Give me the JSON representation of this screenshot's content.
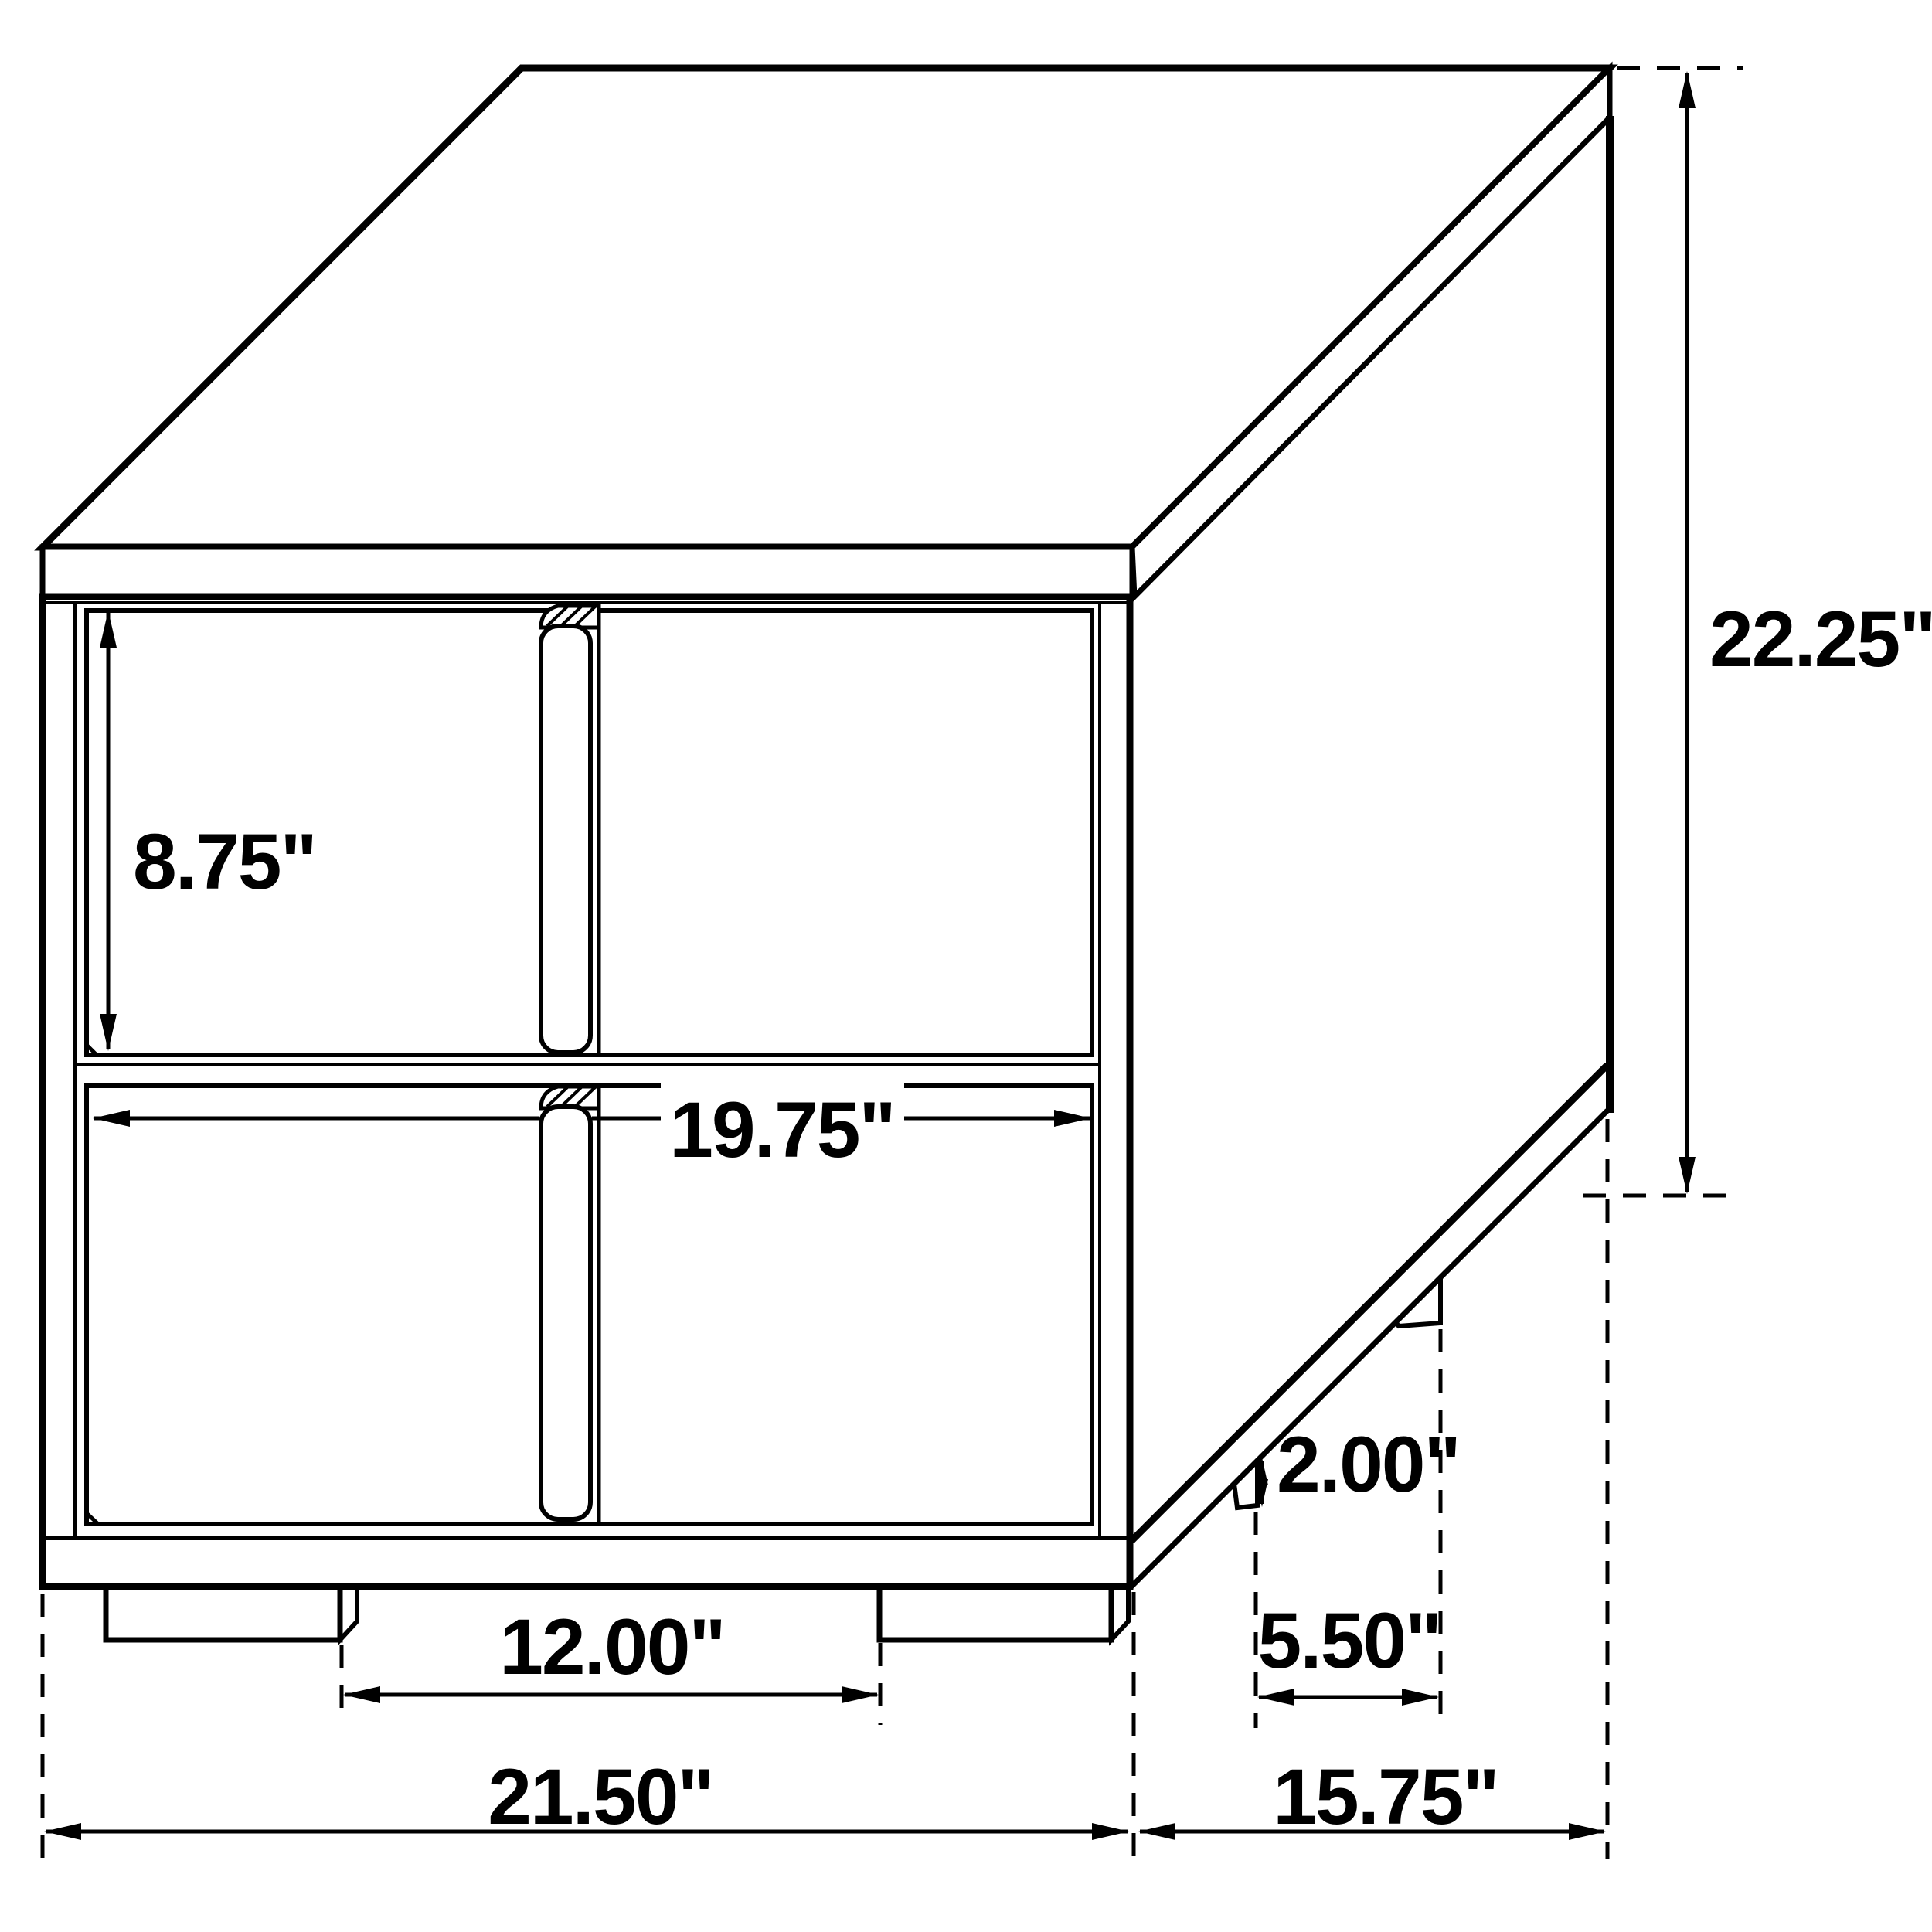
{
  "figure": {
    "type": "furniture-dimension-diagram",
    "subject": "Two-drawer nightstand, isometric technical line drawing",
    "units": "inches"
  },
  "dimensions": {
    "drawer_section_height": {
      "label": "8.75\"",
      "value": 8.75
    },
    "drawer_width": {
      "label": "19.75\"",
      "value": 19.75
    },
    "overall_height": {
      "label": "22.25\"",
      "value": 22.25
    },
    "front_feet_spacing": {
      "label": "12.00\"",
      "value": 12.0
    },
    "foot_height": {
      "label": "2.00\"",
      "value": 2.0
    },
    "side_feet_spacing": {
      "label": "5.50\"",
      "value": 5.5
    },
    "overall_width": {
      "label": "21.50\"",
      "value": 21.5
    },
    "overall_depth": {
      "label": "15.75\"",
      "value": 15.75
    }
  }
}
